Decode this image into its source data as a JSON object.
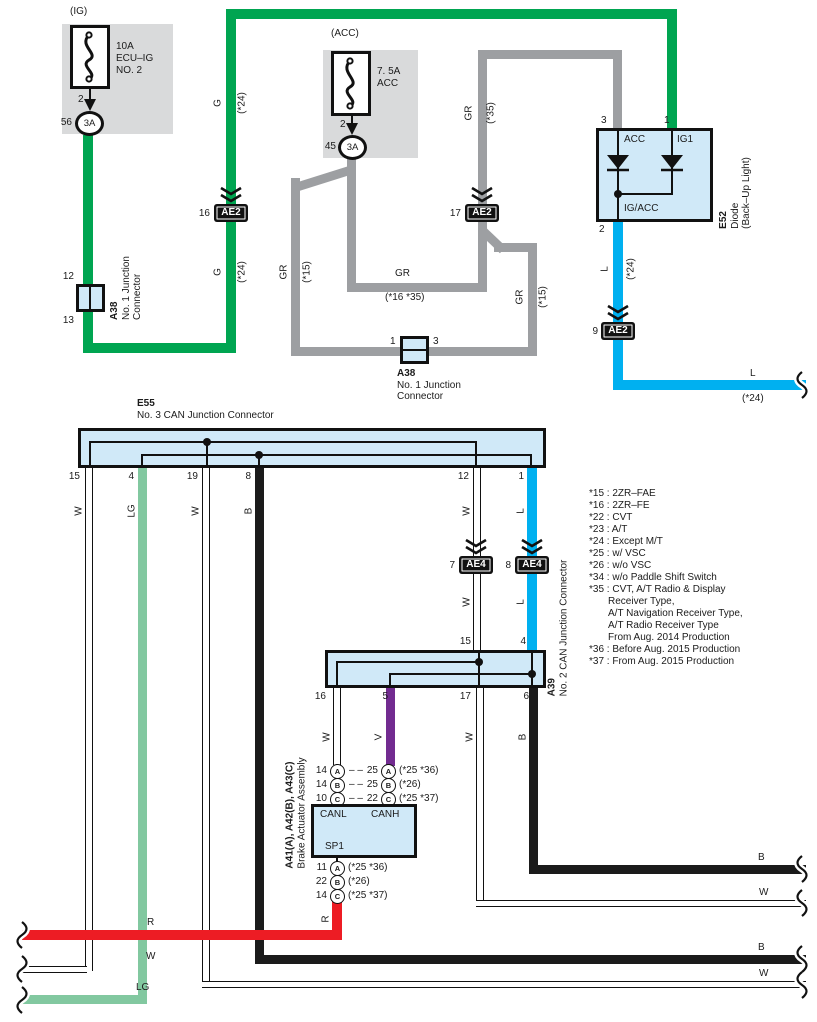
{
  "colors": {
    "green": "#00a551",
    "gray": "#9d9fa2",
    "cyan": "#00b0f0",
    "black": "#1b1b1b",
    "light_green": "#82c8a0",
    "violet": "#722b90",
    "red": "#ed1c24",
    "box_fill": "#d0e9f8",
    "panel_gray": "#d9dadb"
  },
  "fuse_ig": {
    "tag": "(IG)",
    "line1": "10A",
    "line2": "ECU–IG",
    "line3": "NO. 2",
    "pin": "2",
    "conn_no": "56",
    "conn": "3A"
  },
  "fuse_acc": {
    "tag": "(ACC)",
    "line1": "7. 5A",
    "line2": "ACC",
    "pin": "2",
    "conn_no": "45",
    "conn": "3A"
  },
  "diode": {
    "id": "E52",
    "name": "Diode",
    "name2": "(Back–Up Light)",
    "pin_acc": "3",
    "pin_ig1": "1",
    "pin_out": "2",
    "in_acc": "ACC",
    "in_ig1": "IG1",
    "out": "IG/ACC"
  },
  "a38_left": {
    "id": "A38",
    "name": "No. 1 Junction",
    "name2": "Connector",
    "pin_top": "12",
    "pin_bot": "13"
  },
  "a38_mid": {
    "id": "A38",
    "name": "No. 1 Junction",
    "name2": "Connector",
    "pin_l": "1",
    "pin_r": "3"
  },
  "e55": {
    "id": "E55",
    "name": "No. 3 CAN Junction Connector",
    "pins": [
      "15",
      "4",
      "19",
      "8",
      "12",
      "1"
    ]
  },
  "a39": {
    "id": "A39",
    "name": "No. 2 CAN Junction Connector",
    "pins_top": [
      "15",
      "4"
    ],
    "pins_bot": [
      "16",
      "5",
      "17",
      "6"
    ]
  },
  "connectors": {
    "ae2_16": {
      "no": "16",
      "label": "AE2"
    },
    "ae2_17": {
      "no": "17",
      "label": "AE2"
    },
    "ae2_9": {
      "no": "9",
      "label": "AE2"
    },
    "ae4_7": {
      "no": "7",
      "label": "AE4"
    },
    "ae4_8": {
      "no": "8",
      "label": "AE4"
    }
  },
  "brake": {
    "id": "A41(A), A42(B), A43(C)",
    "name": "Brake Actuator Assembly",
    "canl": "CANL",
    "canh": "CANH",
    "sp1": "SP1",
    "dash": "– –",
    "rows_top": [
      {
        "l_no": "14",
        "l": "A",
        "r_no": "25",
        "r": "A",
        "note": "(*25 *36)"
      },
      {
        "l_no": "14",
        "l": "B",
        "r_no": "25",
        "r": "B",
        "note": "(*26)"
      },
      {
        "l_no": "10",
        "l": "C",
        "r_no": "22",
        "r": "C",
        "note": "(*25 *37)"
      }
    ],
    "rows_bot": [
      {
        "no": "11",
        "c": "A",
        "note": "(*25 *36)"
      },
      {
        "no": "22",
        "c": "B",
        "note": "(*26)"
      },
      {
        "no": "14",
        "c": "C",
        "note": "(*25 *37)"
      }
    ]
  },
  "wire_labels": {
    "g_top": "G",
    "g_top_note": "(*24)",
    "g_mid": "G",
    "g_mid_note": "(*24)",
    "gr_left": "GR",
    "gr_left_note": "(*15)",
    "gr_mid": "GR",
    "gr_mid_note": "(*16 *35)",
    "gr_right": "GR",
    "gr_right_note": "(*15)",
    "gr_acc": "GR",
    "gr_acc_note": "(*35)",
    "l_vert": "L",
    "l_vert_note": "(*24)",
    "l_horiz": "L",
    "l_horiz_note": "(*24)",
    "e55_w15": "W",
    "e55_lg4": "LG",
    "e55_w19": "W",
    "e55_b8": "B",
    "e55_w12": "W",
    "e55_l1": "L",
    "ae4_w": "W",
    "ae4_l": "L",
    "a39_w16": "W",
    "a39_v5": "V",
    "a39_w17": "W",
    "a39_b6": "B",
    "r_vert": "R",
    "bottom_r": "R",
    "bottom_w": "W",
    "bottom_lg": "LG",
    "right_b1": "B",
    "right_w1": "W",
    "right_b2": "B",
    "right_w2": "W"
  },
  "notes": [
    "*15 : 2ZR–FAE",
    "*16 : 2ZR–FE",
    "*22 : CVT",
    "*23 : A/T",
    "*24 : Except M/T",
    "*25 : w/ VSC",
    "*26 : w/o VSC",
    "*34 : w/o Paddle Shift Switch",
    "*35 : CVT, A/T Radio & Display",
    "Receiver Type,",
    "A/T Navigation Receiver Type,",
    "A/T Radio Receiver Type",
    "From Aug. 2014 Production",
    "*36 : Before Aug. 2015 Production",
    "*37 : From Aug. 2015 Production"
  ]
}
